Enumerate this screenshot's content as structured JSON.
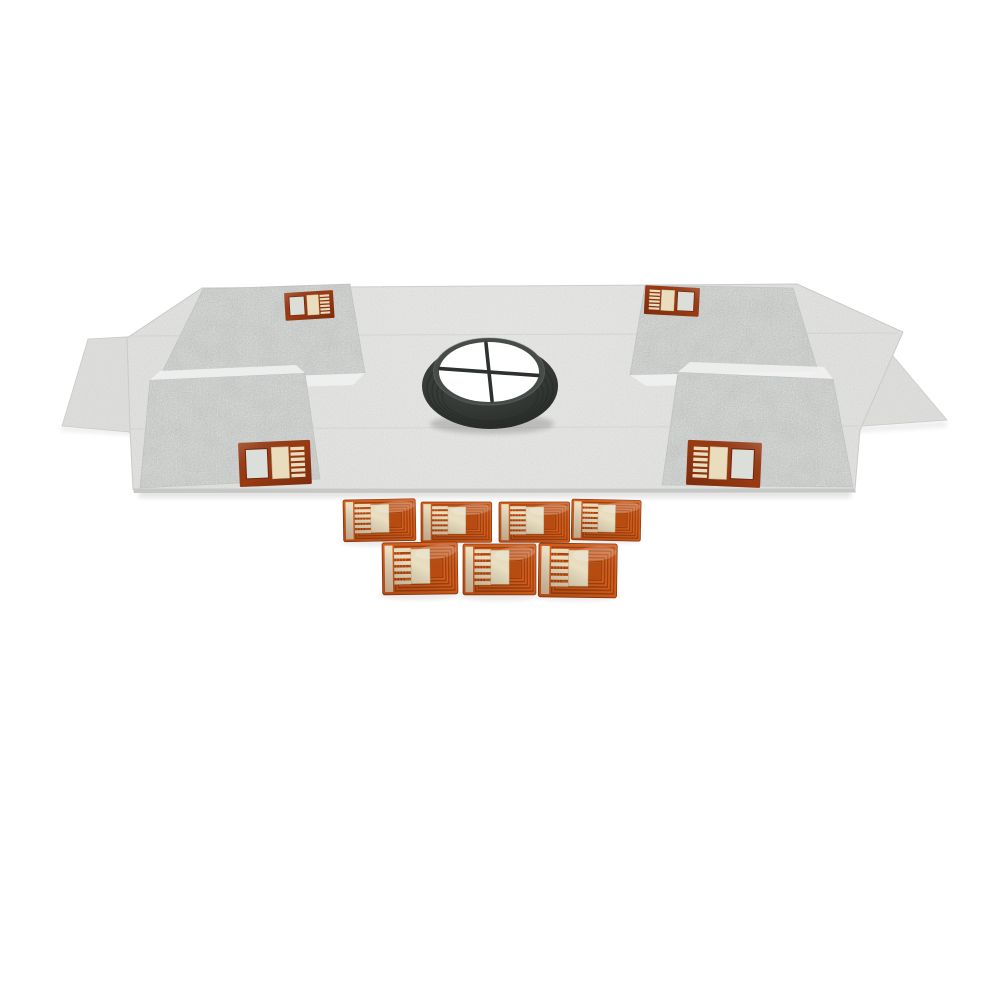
{
  "meta": {
    "type": "product-photo",
    "title": "Shower waterproofing membrane drain kit with flexible circuit pads",
    "description": "Overhead studio photo on a seamless white background: a light-gray non-woven waterproofing membrane sheet with two side flaps and four folded corner flaps, each corner fitted with an orange flexible-circuit patch; a black ribbed rubber drain seal ring with a white drain opening and crossbars sits at the center of the sheet; seven loose orange flexible-circuit pads are arranged below the sheet in two rows.",
    "background_color": "#ffffff"
  },
  "colors": {
    "background": "#ffffff",
    "membrane_base": "#e3e4e2",
    "membrane_wing": "#dfe0de",
    "membrane_corner": "#d7d9d7",
    "membrane_edge": "#c6c8c6",
    "crease": "#c2c5c2",
    "curl_highlight": "#eff1ef",
    "drain_outer": "#383c39",
    "drain_mid": "#474c48",
    "drain_rib": "#242825",
    "drain_opening": "#ffffff",
    "drain_cross": "#2e322f",
    "pad_body": "#d45f1e",
    "pad_body_deep": "#b84c10",
    "pad_coil": "#a2400c",
    "pad_cream": "#eadfc2",
    "patch_frame": "#9a3a13",
    "patch_window": "#dcdeda",
    "patch_cream": "#e9ddbe"
  },
  "scene": {
    "membrane": {
      "label": "gray fabric waterproofing membrane sheet",
      "side_flaps": 2,
      "corner_flaps": 4
    },
    "drain_seal": {
      "label": "black rubber drain seal ring",
      "opening": "white circular drain opening with crossbars",
      "crossbars": 2
    },
    "corner_patches": {
      "label": "orange flexible circuit patch on membrane corner",
      "count": 4
    },
    "flex_pads": {
      "label": "orange flexible circuit pad",
      "count": 7,
      "row_layout": "4 top row, 3 bottom row"
    }
  }
}
